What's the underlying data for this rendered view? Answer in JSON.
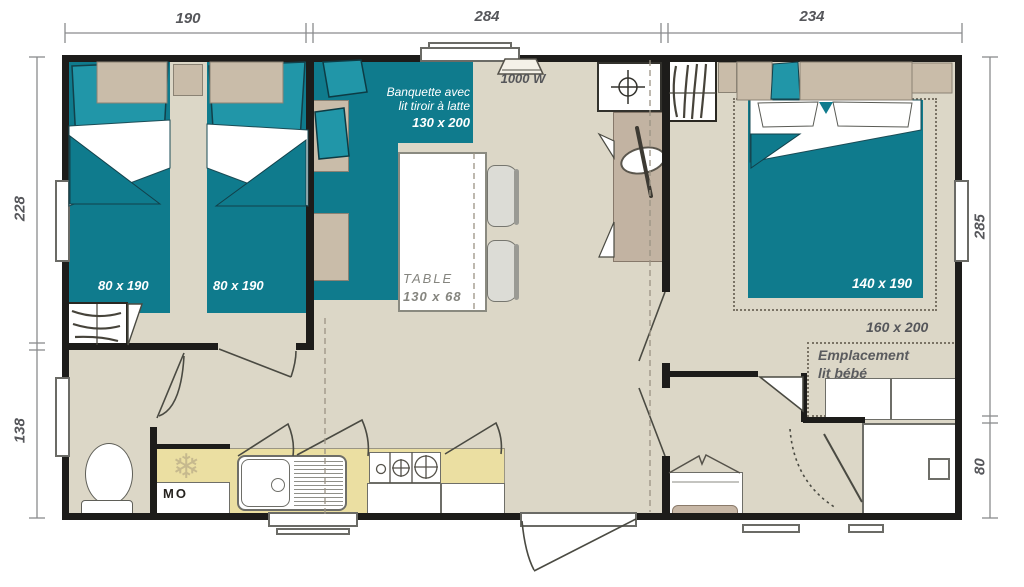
{
  "title": "Mobile home floor plan",
  "dimensions": {
    "top": [
      "190",
      "284",
      "234"
    ],
    "left": [
      "228",
      "138"
    ],
    "right": [
      "285",
      "80"
    ]
  },
  "labels": {
    "bed_twin_1": "80 x 190",
    "bed_twin_2": "80 x 190",
    "banquette": {
      "line1": "Banquette avec",
      "line2": "lit tiroir à latte",
      "size": "130 x 200"
    },
    "heater_watts": "1000 W",
    "table": {
      "name": "TABLE",
      "size": "130 x 68"
    },
    "bed_master_size": "140 x 190",
    "bed_master_option_size": "160 x 200",
    "baby_spot": {
      "line1": "Emplacement",
      "line2": "lit bébé"
    },
    "microwave": "MO",
    "fridge_icon": "❄"
  },
  "colors": {
    "teal": "#0f7b8d",
    "teal_light": "#2196a8",
    "tan": "#c9bca9",
    "floor": "#dcd7c7",
    "kitchen_counter": "#ebdfa2",
    "wall": "#1d1c1a",
    "label_gray": "#55565a"
  }
}
